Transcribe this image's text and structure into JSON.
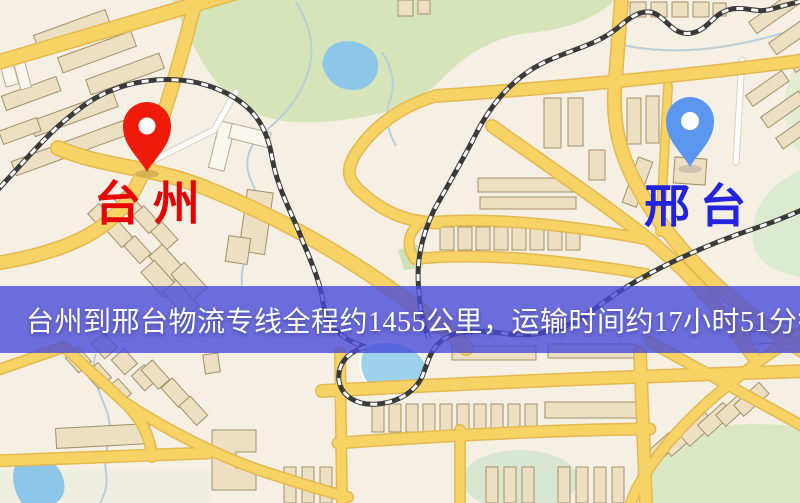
{
  "banner": {
    "text": "台州到邢台物流专线全程约1455公里，运输时间约17小时51分钟.",
    "background_color": "#5457dd",
    "text_color": "#ffffff"
  },
  "route": {
    "origin": "台州",
    "destination": "邢台",
    "service": "物流专线",
    "distance_text": "全程约1455公里",
    "duration_text": "运输时间约17小时51分钟"
  },
  "markers": {
    "origin": {
      "label": "台州",
      "pin_color": "#ee1b0b",
      "label_color": "#e60303"
    },
    "destination": {
      "label": "邢台",
      "pin_color": "#5b97ef",
      "label_color": "#2323dd"
    }
  },
  "map": {
    "style": "street-map-illustration",
    "palette": {
      "background": "#f5efe4",
      "park": "#d6e5b9",
      "park_light": "#e2ecd2",
      "water": "#8cc6e9",
      "road": "#f7d365",
      "road_casing": "#e5b94f",
      "building": "#ecdfc2",
      "railway": "#3a3a3a"
    }
  }
}
